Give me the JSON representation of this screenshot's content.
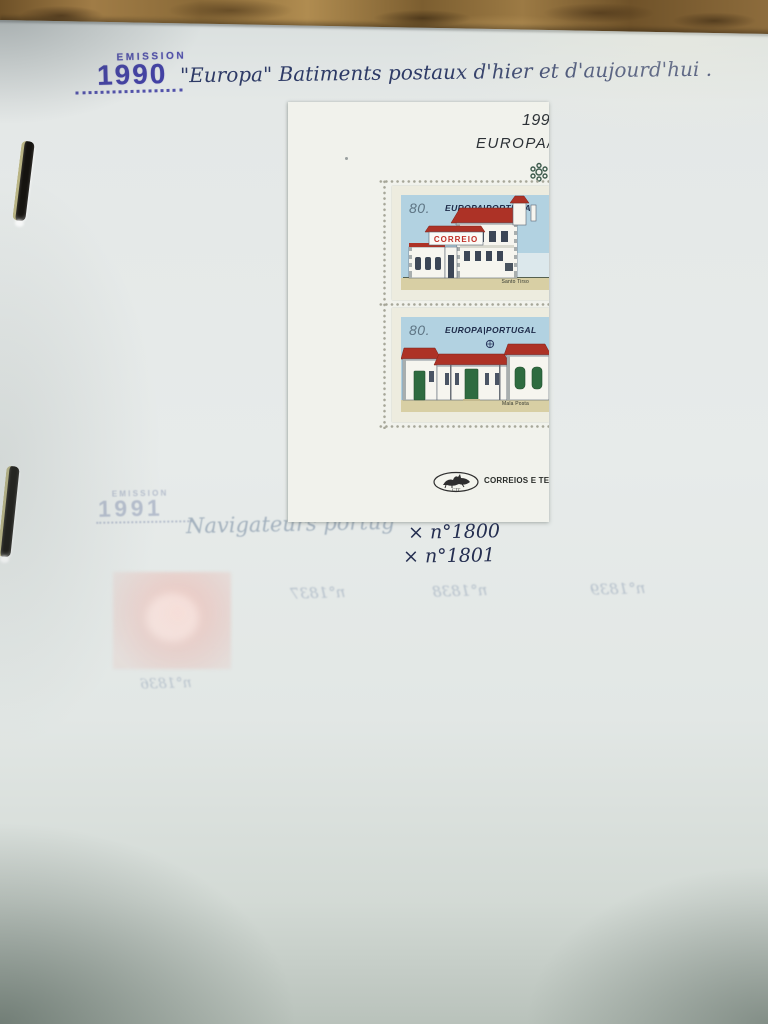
{
  "header": {
    "emission_label": "EMISSION",
    "emission_year": "1990",
    "title": "\"Europa\" Batiments postaux d'hier et d'aujourd'hui ."
  },
  "sheet": {
    "year": "1990",
    "europa": "EUROPA/",
    "logo_text": "CORREIOS E TELECO",
    "logo_initials": "CTT",
    "stamps": [
      {
        "value": "80.",
        "header": "EUROPA|PORTUGAL",
        "sign": "CORREIO",
        "caption": "Santo Tirso"
      },
      {
        "value": "80.",
        "header": "EUROPA|PORTUGAL",
        "caption": "Mala Posta"
      }
    ]
  },
  "annotations": {
    "catalog_1": "× n°1800",
    "catalog_2": "× n°1801"
  },
  "showthrough": {
    "emission_label": "EMISSION",
    "emission_year": "1991",
    "handwriting": "Navigateurs portug",
    "numbers": [
      "n°1837",
      "n°1838",
      "n°1839"
    ],
    "number_bottom": "n°1836"
  },
  "colors": {
    "rubber_stamp_ink": "#4342a4",
    "handwriting_ink": "#2d3a66",
    "page": "#e4e8e7",
    "sheet": "#f1f2ec",
    "stamp_sky": "#b2d2e1",
    "roof_red": "#ad3226",
    "door_green": "#2e6b40",
    "ground_tan": "#d8cfa4",
    "desk_wood": "#8a6a38"
  }
}
